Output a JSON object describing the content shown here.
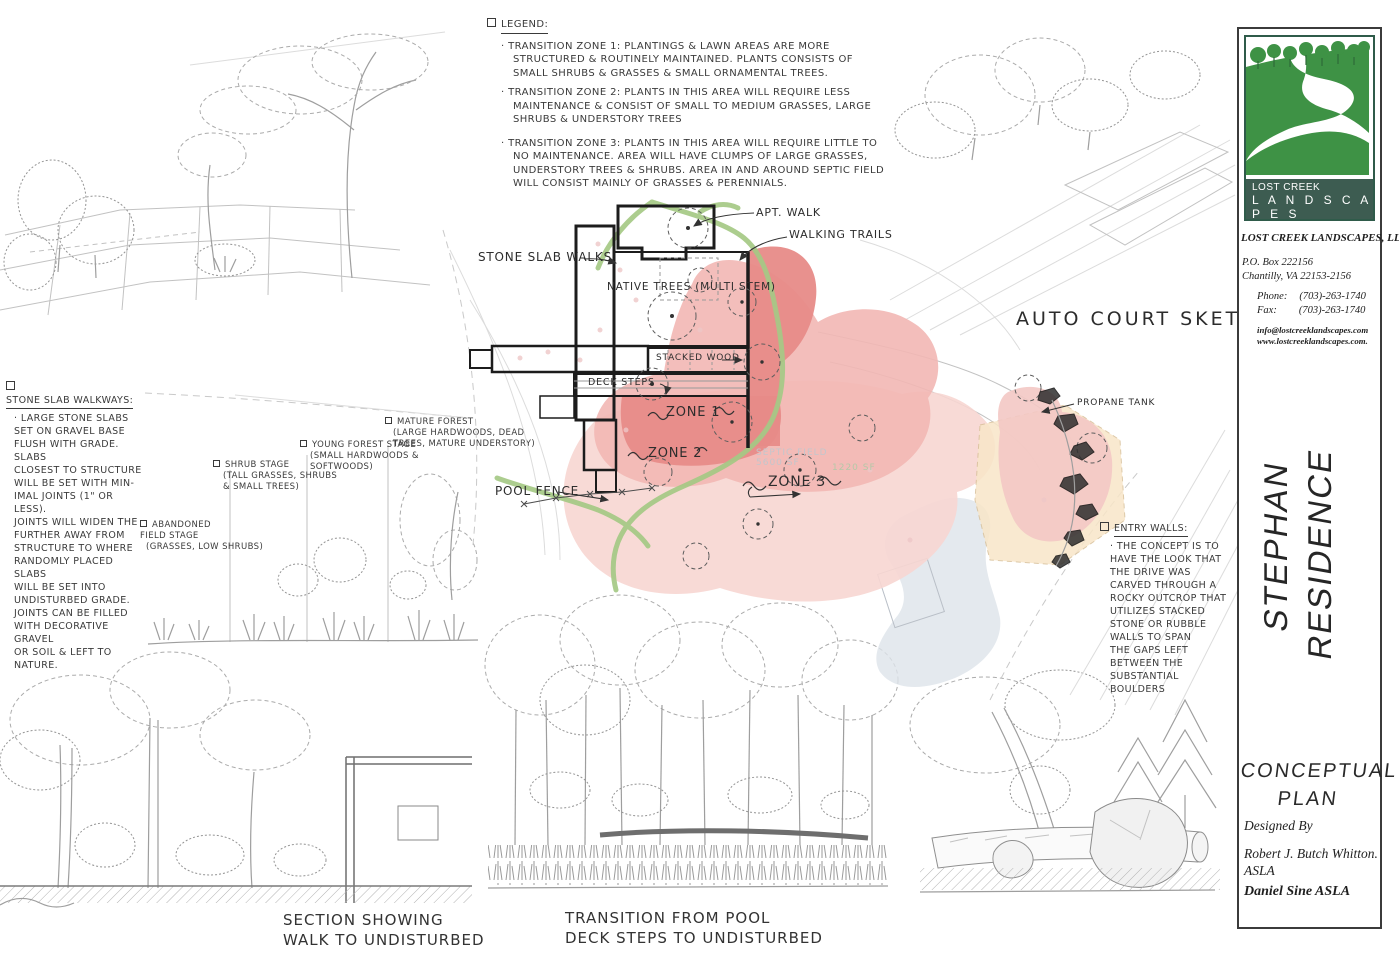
{
  "legend": {
    "title": "LEGEND:",
    "items": [
      "· TRANSITION ZONE 1:  PLANTINGS & LAWN AREAS ARE MORE STRUCTURED & ROUTINELY MAINTAINED. PLANTS CONSISTS OF SMALL SHRUBS & GRASSES & SMALL ORNAMENTAL TREES.",
      "· TRANSITION ZONE 2:  PLANTS IN THIS AREA WILL REQUIRE LESS MAINTENANCE & CONSIST OF SMALL TO MEDIUM GRASSES, LARGE SHRUBS & UNDERSTORY TREES",
      "· TRANSITION ZONE 3:  PLANTS IN THIS AREA WILL REQUIRE LITTLE TO NO MAINTENANCE. AREA WILL HAVE CLUMPS OF LARGE GRASSES, UNDERSTORY TREES & SHRUBS. AREA IN AND AROUND SEPTIC FIELD WILL CONSIST MAINLY OF GRASSES & PERENNIALS."
    ]
  },
  "notes": {
    "stone_slab_title": "STONE SLAB WALKWAYS:",
    "stone_slab_body": "· LARGE STONE SLABS\nSET ON GRAVEL BASE\nFLUSH WITH GRADE. SLABS\nCLOSEST TO STRUCTURE\nWILL BE SET WITH MIN-\nIMAL JOINTS (1\" OR LESS).\nJOINTS WILL WIDEN THE\nFURTHER AWAY FROM\nSTRUCTURE TO WHERE\nRANDOMLY PLACED SLABS\nWILL BE SET INTO\nUNDISTURBED GRADE.\nJOINTS CAN BE FILLED\nWITH DECORATIVE GRAVEL\nOR SOIL & LEFT TO NATURE.",
    "entry_walls_title": "ENTRY WALLS:",
    "entry_walls_body": "· THE CONCEPT IS TO\nHAVE THE LOOK THAT\nTHE DRIVE WAS\nCARVED THROUGH A\nROCKY OUTCROP THAT\nUTILIZES STACKED\nSTONE OR RUBBLE\nWALLS TO SPAN\nTHE GAPS LEFT\nBETWEEN THE\nSUBSTANTIAL BOULDERS"
  },
  "succession": {
    "labels": [
      {
        "title": "ABANDONED\nFIELD STAGE",
        "sub": "(GRASSES, LOW SHRUBS)"
      },
      {
        "title": "SHRUB STAGE",
        "sub": "(TALL GRASSES, SHRUBS\n& SMALL TREES)"
      },
      {
        "title": "YOUNG FOREST STAGE",
        "sub": "(SMALL HARDWOODS &\nSOFTWOODS)"
      },
      {
        "title": "MATURE FOREST",
        "sub": "(LARGE HARDWOODS, DEAD\nTREES, MATURE UNDERSTORY)"
      }
    ]
  },
  "plan": {
    "labels": {
      "stone_slab_walks": "STONE SLAB WALKS",
      "native_trees": "NATIVE TREES (MULTI STEM)",
      "apt_walk": "APT. WALK",
      "walking_trails": "WALKING TRAILS",
      "stacked_wood": "STACKED WOOD",
      "deck_steps": "DECK STEPS",
      "zone1": "ZONE 1",
      "zone2": "ZONE 2",
      "zone3": "ZONE 3",
      "pool_fence": "POOL FENCE",
      "propane_tank": "PROPANE TANK"
    },
    "faint": {
      "septic": "SEPTIC FIELD\n5600 SF",
      "area_sf": "1220 SF"
    }
  },
  "captions": {
    "section": "SECTION SHOWING\nWALK TO UNDISTURBED",
    "transition": "TRANSITION FROM POOL\nDECK STEPS TO UNDISTURBED",
    "auto_court": "AUTO COURT SKETCH"
  },
  "titleblock": {
    "logo": {
      "line1": "LOST CREEK",
      "line2": "L A N D S C A P E S"
    },
    "company": "LOST CREEK LANDSCAPES, LLC",
    "address1": "P.O. Box 222156",
    "address2": "Chantilly,  VA 22153-2156",
    "phone_label": "Phone:",
    "phone": "(703)-263-1740",
    "fax_label": "Fax:",
    "fax": "(703)-263-1740",
    "email": "info@lostcreeklandscapes.com",
    "website": "www.lostcreeklandscapes.com.",
    "project": "STEPHAN\nRESIDENCE",
    "doc_title": "CONCEPTUAL\nPLAN",
    "designed_by": "Designed By",
    "designer1": "Robert J. Butch Whitton.\nASLA",
    "designer2": "Daniel Sine  ASLA"
  },
  "colors": {
    "logo_green": "#3e9245",
    "logo_band": "#3d5c51",
    "zone1": "#e78b88",
    "zone2": "#f2b7b4",
    "zone3": "#f7d6d1",
    "septic": "#f8e6c8",
    "trail_green": "#a5c985",
    "drive_wash": "#dde3ea"
  }
}
